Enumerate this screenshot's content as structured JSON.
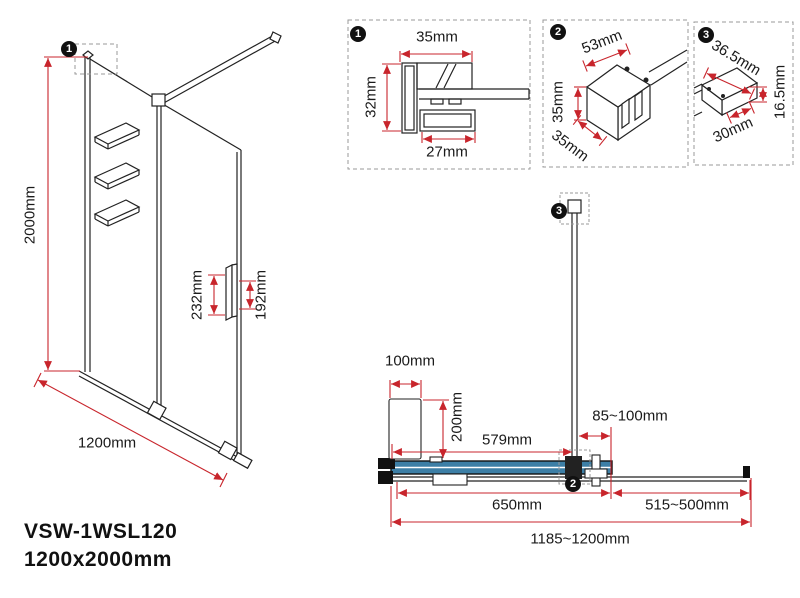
{
  "title": {
    "model": "VSW-1WSL120",
    "dimensions": "1200x2000mm"
  },
  "colors": {
    "dimension_red": "#c8252c",
    "glass_blue": "#3d7fa6",
    "line_black": "#1a1a1a"
  },
  "elevation": {
    "marker": "1",
    "labels": {
      "height": "2000mm",
      "width": "1200mm",
      "handle_height": "232mm",
      "handle_spacing": "192mm"
    }
  },
  "details": [
    {
      "marker": "1",
      "labels": {
        "top": "35mm",
        "side": "32mm",
        "bottom": "27mm"
      }
    },
    {
      "marker": "2",
      "labels": {
        "top": "53mm",
        "side": "35mm",
        "bottom": "35mm"
      }
    },
    {
      "marker": "3",
      "labels": {
        "top": "36.5mm",
        "side": "16.5mm",
        "bottom": "30mm"
      }
    }
  ],
  "plan": {
    "marker_bar_end": "3",
    "marker_bar_clamp": "2",
    "labels": {
      "wall_clearance_width": "100mm",
      "wall_clearance_depth": "200mm",
      "bar_position": "579mm",
      "bar_to_wall": "85~100mm",
      "fixed_panel": "650mm",
      "bar_extension": "515~500mm",
      "overall_width": "1185~1200mm"
    }
  }
}
